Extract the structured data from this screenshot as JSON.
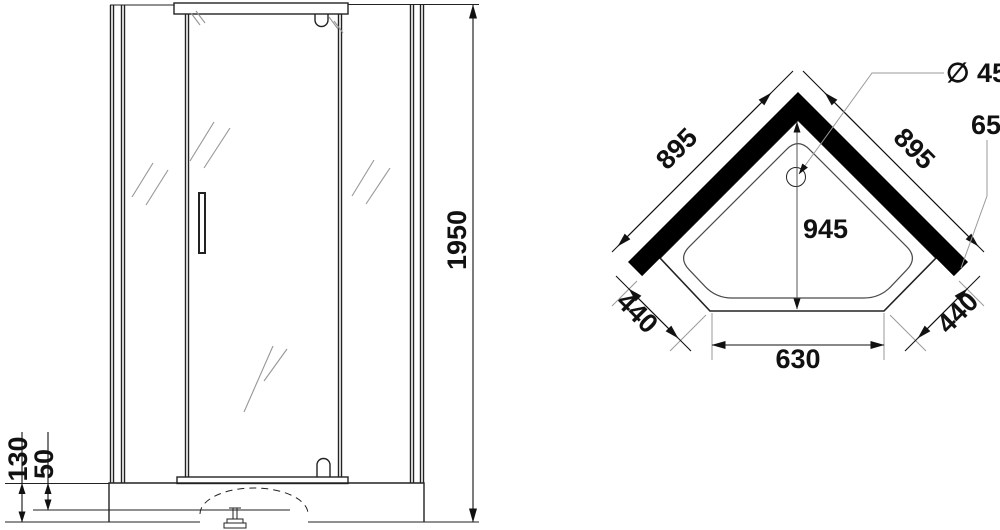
{
  "drawing": {
    "title": "corner-shower-cabin-technical-drawing",
    "front_view": {
      "height": "1950",
      "base_height": "130",
      "base_lip": "50"
    },
    "plan_view": {
      "wall_left": "895",
      "wall_right": "895",
      "depth": "945",
      "side_left": "440",
      "side_right": "440",
      "front_width": "630",
      "drain": "∅ 45",
      "profile": "65"
    },
    "colors": {
      "line": "#222222",
      "dimension": "#111111",
      "extension": "#9a9a9a",
      "wall_fill": "#000000",
      "background": "#ffffff"
    }
  }
}
